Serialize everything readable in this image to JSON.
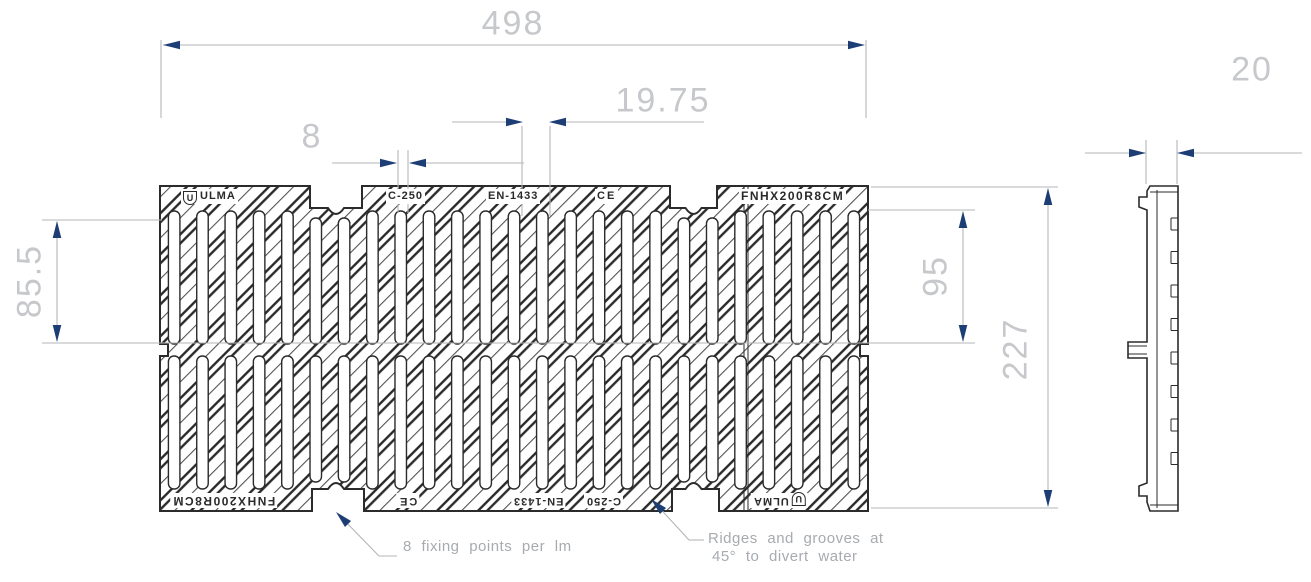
{
  "plate": {
    "brand": "ULMA",
    "brand_initial": "U",
    "load_class": "C-250",
    "standard": "EN-1433",
    "ce_mark": "CE",
    "model": "FNHX200R8CM"
  },
  "dimensions": {
    "overall_length": "498",
    "slot_pitch": "19.75",
    "slot_width": "8",
    "slot_length": "85.5",
    "inner_span": "95",
    "overall_width": "227",
    "thickness": "20"
  },
  "annotations": {
    "fixing_points": "8 fixing points per lm",
    "ridges_note_line1": "Ridges and grooves at",
    "ridges_note_line2": "45° to divert water"
  },
  "pattern": {
    "slots_per_row": 25,
    "rows": 2,
    "ridge_angle_deg": 45
  },
  "colors": {
    "drawing_line": "#2b2b2b",
    "groove_line": "#555555",
    "dimension_line": "#b3b6b9",
    "dimension_text": "#c6c8cb",
    "arrowhead": "#1d3e74",
    "annotation_text": "#a7abaf",
    "background": "#ffffff"
  }
}
